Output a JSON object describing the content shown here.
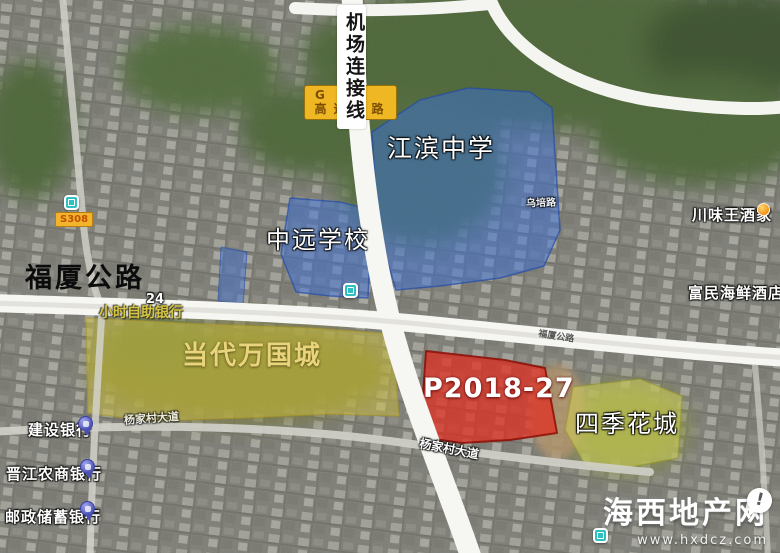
{
  "roads": {
    "airport_link": "机场连接线",
    "fuxia_main": "福厦公路",
    "fuxia_small": "福厦公路",
    "yangjiacun_left": "杨家村大道",
    "yangjiacun_right": "杨家村大道",
    "wupei": "乌培路"
  },
  "signs": {
    "s308": "S308",
    "g_line1": "G",
    "g_line2": "高速公路"
  },
  "zones": {
    "jiangbin_school": "江滨中学",
    "zhongyuan_school": "中远学校",
    "dangdai_wanguo": "当代万国城",
    "parcel": "P2018-27",
    "siji_huacheng": "四季花城"
  },
  "pois": {
    "atm_line1": "24",
    "atm_line2": "小时自助银行",
    "ccb_bank": "建设银行",
    "jinjiang_bank": "晋江农商银行",
    "postal_bank": "邮政储蓄银行",
    "chuanweiwang": "川味王酒家",
    "fumin_hotel": "富民海鲜酒店"
  },
  "watermark": {
    "title": "海西地产网",
    "url": "www.hxdcz.com",
    "badge": "!"
  },
  "colors": {
    "zone_blue": "#3a6fd8",
    "zone_yellow": "#d8c83e",
    "zone_red": "#e33224",
    "zone_green_yellow": "#d6d65a",
    "road_sign_yellow": "#f0b429",
    "transit_teal": "#2fc0c4",
    "pin_purple": "#6a6fc9"
  }
}
